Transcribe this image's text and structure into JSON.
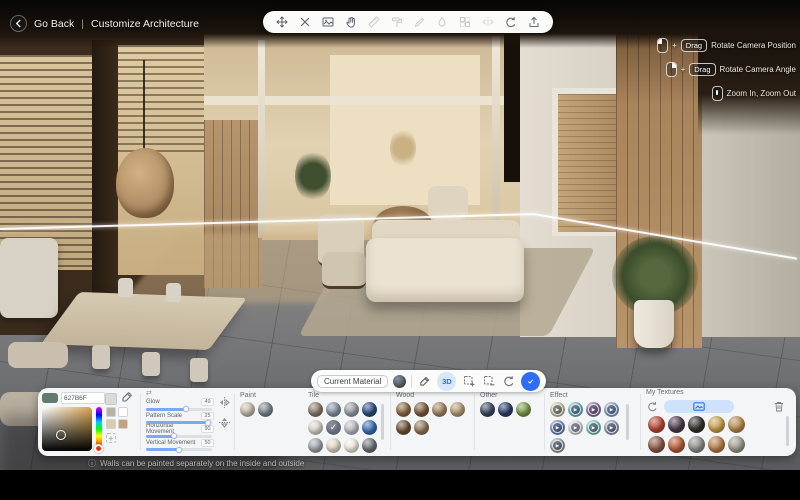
{
  "header": {
    "back_label": "Go Back",
    "separator": "|",
    "title": "Customize Architecture"
  },
  "icons": {
    "info": "ⓘ",
    "check": "✓",
    "play": "▶",
    "plus": "+",
    "swap": "⇄"
  },
  "camera_hints": [
    {
      "plus": "+",
      "badge": "Drag",
      "label": "Rotate Camera Position"
    },
    {
      "plus": "+",
      "badge": "Drag",
      "label": "Rotate Camera Angle"
    },
    {
      "label": "Zoom In, Zoom Out"
    }
  ],
  "material_bar": {
    "current_material_label": "Current Material",
    "mode_3d_label": "3D"
  },
  "color_picker": {
    "hex_value": "627B6F",
    "quick_swatches": [
      "#b8b2a6",
      "#ffffff",
      "#ddccab",
      "#c3a277"
    ]
  },
  "sliders": [
    {
      "label": "Glow",
      "value": "49",
      "fill": 60
    },
    {
      "label": "Pattern Scale",
      "value": "25",
      "fill": 94
    },
    {
      "label": "Horizontal Movement",
      "value": "90",
      "fill": 42
    },
    {
      "label": "Vertical Movement",
      "value": "50",
      "fill": 50
    }
  ],
  "materials": {
    "paint": {
      "label": "Paint",
      "swatches": [
        {
          "color": "#c7bcae"
        },
        {
          "color": "#7e858f"
        }
      ]
    },
    "tile": {
      "label": "Tile",
      "swatches": [
        {
          "color": "#8b7a6e"
        },
        {
          "color": "#8593a2"
        },
        {
          "color": "#989ca3"
        },
        {
          "color": "#2e4e80"
        },
        {
          "color": "#d9d5cd"
        },
        {
          "color": "#a9b1b8",
          "selected": true
        },
        {
          "color": "#b9bec4"
        },
        {
          "color": "#3e6fb0"
        },
        {
          "color": "#9ea5ac"
        },
        {
          "color": "#e2d8c6"
        },
        {
          "color": "#efe9e1"
        },
        {
          "color": "#6d7379"
        }
      ]
    },
    "wood": {
      "label": "Wood",
      "swatches": [
        {
          "color": "#8a6947"
        },
        {
          "color": "#7b5d41"
        },
        {
          "color": "#a28762"
        },
        {
          "color": "#b69b75"
        },
        {
          "color": "#6c5239"
        },
        {
          "color": "#917757"
        }
      ]
    },
    "other": {
      "label": "Other",
      "swatches": [
        {
          "color": "#3a4a64"
        },
        {
          "color": "#2e3f67"
        },
        {
          "color": "#7b9b4e"
        }
      ]
    },
    "effect": {
      "label": "Effect",
      "swatches": [
        {
          "color": "#cfc9a1",
          "effect": true
        },
        {
          "color": "#6fbccc",
          "effect": true
        },
        {
          "color": "#9a70ae",
          "effect": true
        },
        {
          "color": "#80a9d9",
          "effect": true
        },
        {
          "color": "#7090c9",
          "effect": true
        },
        {
          "color": "#d9dee3",
          "effect": true
        },
        {
          "color": "#80c9c1",
          "effect": true
        },
        {
          "color": "#90a1b9",
          "effect": true
        },
        {
          "color": "#9aa3ab",
          "effect": true
        }
      ]
    },
    "my_textures": {
      "label": "My Textures",
      "swatches": [
        {
          "color": "#b44a36"
        },
        {
          "color": "#4c3c4e"
        },
        {
          "color": "#34302c"
        },
        {
          "color": "#c79f52"
        },
        {
          "color": "#b78a50"
        },
        {
          "color": "#8a5a48"
        },
        {
          "color": "#b65c3a"
        },
        {
          "color": "#8d8d8b"
        },
        {
          "color": "#b77c4a"
        },
        {
          "color": "#9a9a8c"
        }
      ]
    }
  },
  "footer": {
    "tooltip": "Walls can be painted separately on the inside and outside"
  }
}
